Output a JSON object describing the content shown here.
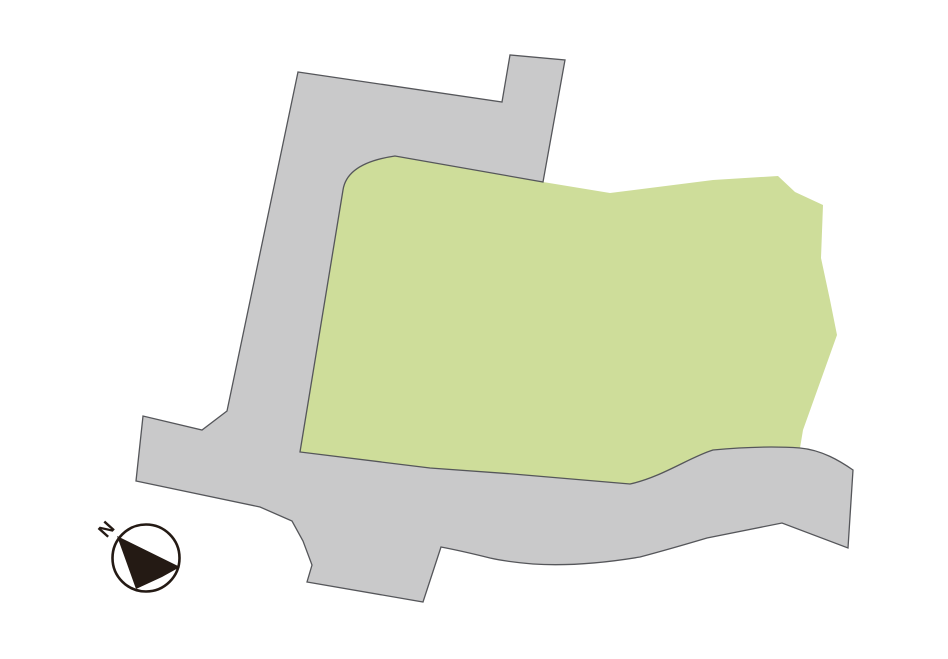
{
  "canvas": {
    "width": 948,
    "height": 659,
    "viewbox": "0 0 948 659",
    "background": "#ffffff"
  },
  "shapes": {
    "road": {
      "label": "road",
      "fill": "#c9c9ca",
      "stroke": "#55565a",
      "stroke_width": 1.3,
      "path": "M 298,72 L 502,102 L 510,55 L 565,60 L 543,182 L 395,156 Q 347,163 343,190 L 300,452 L 430,468 L 513,474 L 630,484 C 662,477 690,457 713,450 C 745,447 772,446 800,448 C 822,450 840,461 853,470 L 848,548 L 782,523 L 707,538 Q 670,549 640,557 Q 580,567 533,564 Q 508,562 490,558 Q 462,551 441,547 L 423,602 L 307,582 L 312,565 L 303,541 L 292,521 L 260,507 L 136,481 L 143,416 L 202,430 L 227,411 Z"
    },
    "parcel": {
      "label": "land-parcel",
      "fill": "#cedd9a",
      "path": "M 395,156 L 543,182 L 610,193 L 713,180 L 778,176 L 795,192 L 823,205 L 821,258 L 830,300 L 837,335 L 803,430 L 800,448 C 772,446 745,447 713,450 C 690,457 662,477 630,484 L 513,474 L 430,468 L 300,452 L 343,190 Q 347,163 395,156 Z"
    }
  },
  "compass": {
    "label": "N",
    "color": "#241a14",
    "circle": {
      "cx": 146,
      "cy": 558,
      "r": 33.5,
      "stroke_width": 2.6
    },
    "arrow_points": "117,536 180,567 162,577 136,589",
    "label_transform": "translate(106,529) rotate(-48)",
    "label_font_size": 19
  }
}
